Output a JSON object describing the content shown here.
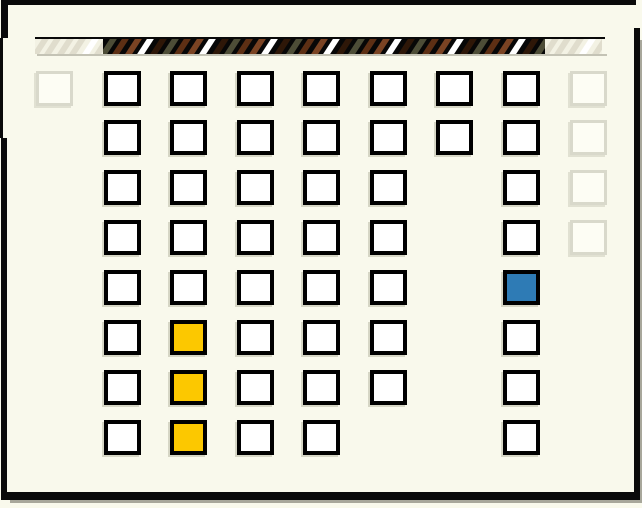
{
  "window": {
    "background": "#f9f9ec",
    "frame_color": "#0a0a0a",
    "shadow_color": "#a8a79b",
    "width": 642,
    "height": 508
  },
  "scrollbar": {
    "top_line": {
      "x": 35,
      "y": 37,
      "width": 570,
      "height": 2,
      "color": "#0a0a0a"
    },
    "bottom_shadow": {
      "x": 37,
      "y": 54,
      "width": 570,
      "height": 2,
      "color": "#c4c3b5"
    },
    "stripe_width": 7,
    "stripe_pitch": 12.4,
    "sections": [
      {
        "id": "track-left",
        "x": 35,
        "width": 68,
        "background": "#f3f2e4",
        "cycle": [
          "#e0ddcd",
          "#e0ddcd",
          "#e0ddcd",
          "#e0ddcd",
          "#ffffff"
        ]
      },
      {
        "id": "thumb",
        "x": 103,
        "width": 442,
        "background": "#070707",
        "cycle": [
          "#4d4d37",
          "#5d2f14",
          "#7a4323",
          "#ffffff",
          "#2e1708"
        ]
      },
      {
        "id": "track-right",
        "x": 545,
        "width": 57,
        "background": "#f3f2e4",
        "cycle": [
          "#e0ddcd",
          "#e0ddcd",
          "#e0ddcd",
          "#ffffff",
          "#e0ddcd"
        ]
      }
    ]
  },
  "palette": {
    "cell_fill": "#ffffff",
    "cell_border": "#000000",
    "faded_fill": "#fdfdf4",
    "faded_border": "#d9d9cb",
    "yellow": "#fcc800",
    "blue": "#2e7bb5"
  },
  "grid": {
    "cell_width": 37,
    "cell_height": 35,
    "columns_x": [
      36,
      104,
      170,
      237,
      303,
      370,
      436,
      503,
      570
    ],
    "rows": [
      {
        "y": 71,
        "cells": [
          "faded",
          "normal",
          "normal",
          "normal",
          "normal",
          "normal",
          "normal",
          "normal",
          "faded"
        ]
      },
      {
        "y": 120,
        "cells": [
          "none",
          "normal",
          "normal",
          "normal",
          "normal",
          "normal",
          "normal",
          "normal",
          "faded"
        ]
      },
      {
        "y": 170,
        "cells": [
          "none",
          "normal",
          "normal",
          "normal",
          "normal",
          "normal",
          "none",
          "normal",
          "faded"
        ]
      },
      {
        "y": 220,
        "cells": [
          "none",
          "normal",
          "normal",
          "normal",
          "normal",
          "normal",
          "none",
          "normal",
          "faded"
        ]
      },
      {
        "y": 270,
        "cells": [
          "none",
          "normal",
          "normal",
          "normal",
          "normal",
          "normal",
          "none",
          "blue",
          "none"
        ]
      },
      {
        "y": 320,
        "cells": [
          "none",
          "normal",
          "yellow",
          "normal",
          "normal",
          "normal",
          "none",
          "normal",
          "none"
        ]
      },
      {
        "y": 370,
        "cells": [
          "none",
          "normal",
          "yellow",
          "normal",
          "normal",
          "normal",
          "none",
          "normal",
          "none"
        ]
      },
      {
        "y": 420,
        "cells": [
          "none",
          "normal",
          "yellow",
          "normal",
          "normal",
          "none",
          "none",
          "normal",
          "none"
        ]
      }
    ]
  },
  "frame_segments": [
    {
      "id": "frame-top",
      "x": 1,
      "y": 0,
      "width": 635,
      "height": 5
    },
    {
      "id": "frame-left-upper",
      "x": 1,
      "y": 0,
      "width": 7,
      "height": 38
    },
    {
      "id": "frame-left-mid",
      "x": 0,
      "y": 38,
      "width": 3,
      "height": 100
    },
    {
      "id": "frame-left-lower",
      "x": 1,
      "y": 138,
      "width": 6,
      "height": 362
    },
    {
      "id": "frame-right",
      "x": 634,
      "y": 28,
      "width": 6,
      "height": 472
    },
    {
      "id": "frame-bottom",
      "x": 1,
      "y": 492,
      "width": 639,
      "height": 8
    }
  ],
  "frame_shadows": [
    {
      "id": "shadow-bottom",
      "x": 10,
      "y": 500,
      "width": 632,
      "height": 3
    },
    {
      "id": "shadow-right",
      "x": 640,
      "y": 40,
      "width": 2,
      "height": 460
    }
  ]
}
